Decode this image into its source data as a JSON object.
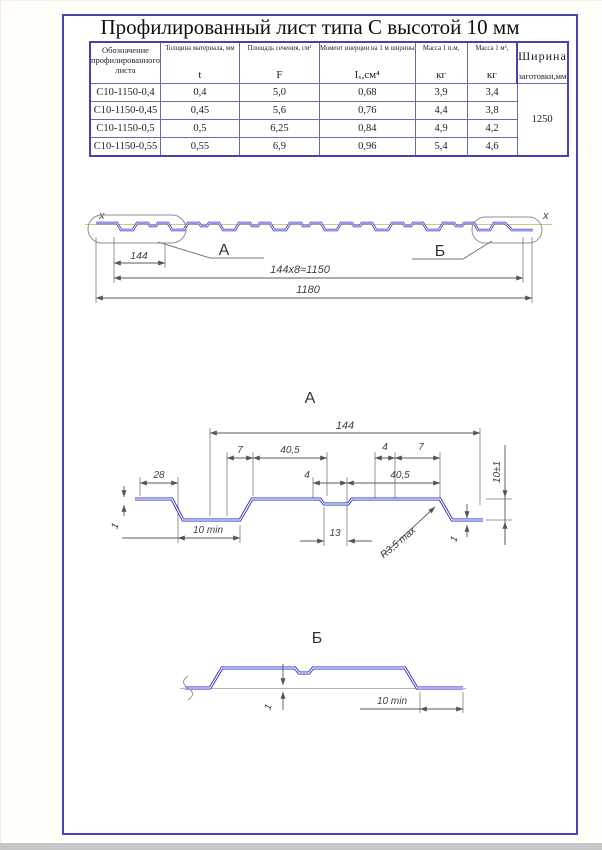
{
  "title": "Профилированный лист типа С высотой 10 мм",
  "table": {
    "columns": [
      {
        "label": "Обозначение профилированного листа",
        "symbol": ""
      },
      {
        "label": "Толщина материала, мм",
        "symbol": "t"
      },
      {
        "label": "Площадь сечения, см²",
        "symbol": "F"
      },
      {
        "label": "Момент инерции на 1 м ширины",
        "symbol": "Iₓ,см⁴"
      },
      {
        "label": "Масса 1 п.м,",
        "symbol": "кг"
      },
      {
        "label": "Масса 1 м²,",
        "symbol": "кг"
      },
      {
        "label": "Ширина",
        "symbol": "заготовки,мм"
      }
    ],
    "rows": [
      [
        "С10-1150-0,4",
        "0,4",
        "5,0",
        "0,68",
        "3,9",
        "3,4"
      ],
      [
        "С10-1150-0,45",
        "0,45",
        "5,6",
        "0,76",
        "4,4",
        "3,8"
      ],
      [
        "С10-1150-0,5",
        "0,5",
        "6,25",
        "0,84",
        "4,9",
        "4,2"
      ],
      [
        "С10-1150-0,55",
        "0,55",
        "6,9",
        "0,96",
        "5,4",
        "4,6"
      ]
    ],
    "blank_width": "1250"
  },
  "overview": {
    "axis_left": "x",
    "axis_right": "x",
    "label_a": "А",
    "label_b": "Б",
    "dim_module": "144",
    "dim_working": "144x8≈1150",
    "dim_total": "1180"
  },
  "detail_a": {
    "title": "А",
    "dim_width": "144",
    "dim_28": "28",
    "dim_7_left": "7",
    "dim_405_top": "40,5",
    "dim_4_right": "4",
    "dim_7_right": "7",
    "dim_4_mid": "4",
    "dim_405_bottom": "40,5",
    "dim_height": "10±1",
    "dim_thick_left": "1",
    "dim_thick_right": "1",
    "dim_10min": "10 min",
    "dim_13": "13",
    "dim_radius": "R3,5 max"
  },
  "detail_b": {
    "title": "Б",
    "dim_thick": "1",
    "dim_10min": "10 min"
  },
  "colors": {
    "frame": "#4543b4",
    "profile_line": "#2a2ac8",
    "axis_line": "#d2c583",
    "dim_line": "#606060"
  }
}
